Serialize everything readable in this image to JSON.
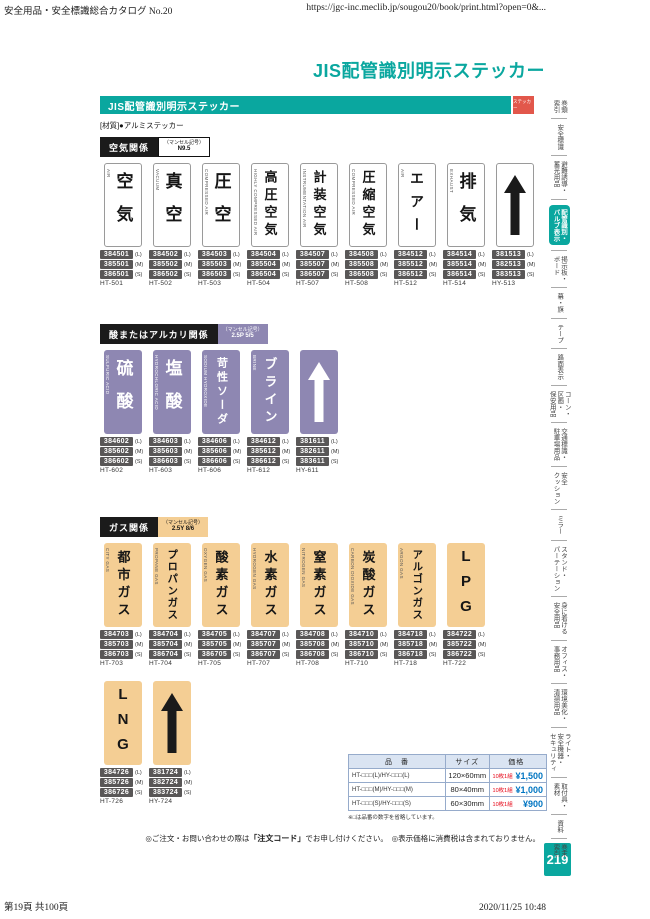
{
  "page": {
    "print_header_left": "安全用品・安全標識総合カタログ No.20",
    "print_header_right": "https://jgc-inc.meclib.jp/sougou20/book/print.html?open=0&...",
    "title": "JIS配管識別明示ステッカー",
    "banner_label": "JIS配管識別明示ステッカー",
    "banner_tag": "ステッカー",
    "material": "[材質]●アルミステッカー",
    "page_number": "219",
    "footer_left": "第19頁 共100頁",
    "footer_right": "2020/11/25 10:48"
  },
  "order_note": {
    "p1": "◎ご注文・お問い合わせの際は",
    "p2": "「注文コード」",
    "p3": "でお申し付けください。　◎表示価格に消費税は含まれておりません。"
  },
  "size_labels": [
    "(L)",
    "(M)",
    "(S)"
  ],
  "sections": [
    {
      "label": "空気関係",
      "munsell_label": "（マンセル記号）",
      "munsell_value": "N9.5",
      "style": "white",
      "rows": [
        [
          {
            "jp": "空気",
            "en": "AIR",
            "codes": [
              "384501",
              "385501",
              "386501"
            ],
            "model": "HT-501"
          },
          {
            "jp": "真空",
            "en": "VACUUM",
            "codes": [
              "384502",
              "385502",
              "386502"
            ],
            "model": "HT-502"
          },
          {
            "jp": "圧空",
            "en": "COMPRESSED AIR",
            "codes": [
              "384503",
              "385503",
              "386503"
            ],
            "model": "HT-503"
          },
          {
            "jp": "高圧空気",
            "en": "HIGHLY COMPRESSED AIR",
            "codes": [
              "384504",
              "385504",
              "386504"
            ],
            "model": "HT-504"
          },
          {
            "jp": "計装空気",
            "en": "INSTRUMENTATION AIR",
            "codes": [
              "384507",
              "385507",
              "386507"
            ],
            "model": "HT-507"
          },
          {
            "jp": "圧縮空気",
            "en": "COMPRESSED AIR",
            "codes": [
              "384508",
              "385508",
              "386508"
            ],
            "model": "HT-508"
          },
          {
            "jp": "エアー",
            "en": "AIR",
            "codes": [
              "384512",
              "385512",
              "386512"
            ],
            "model": "HT-512"
          },
          {
            "jp": "排気",
            "en": "EXHAUST",
            "codes": [
              "384514",
              "385514",
              "386514"
            ],
            "model": "HT-514"
          },
          {
            "arrow": true,
            "icon": "up-arrow",
            "codes": [
              "381513",
              "382513",
              "383513"
            ],
            "model": "HY-513"
          }
        ]
      ]
    },
    {
      "label": "酸またはアルカリ関係",
      "munsell_label": "（マンセル記号）",
      "munsell_value": "2.5P 5/5",
      "style": "purple",
      "rows": [
        [
          {
            "jp": "硫酸",
            "en": "SULFURIC ACID",
            "codes": [
              "384602",
              "385602",
              "386602"
            ],
            "model": "HT-602"
          },
          {
            "jp": "塩酸",
            "en": "HYDROCHLORIC ACID",
            "codes": [
              "384603",
              "385603",
              "386603"
            ],
            "model": "HT-603"
          },
          {
            "jp": "苛性ソーダ",
            "en": "SODIUM HYDROXIDE",
            "codes": [
              "384606",
              "385606",
              "386606"
            ],
            "model": "HT-606"
          },
          {
            "jp": "ブライン",
            "en": "BRINE",
            "codes": [
              "384612",
              "385612",
              "386612"
            ],
            "model": "HT-612"
          },
          {
            "arrow": true,
            "icon": "up-arrow",
            "codes": [
              "381611",
              "382611",
              "383611"
            ],
            "model": "HY-611"
          }
        ]
      ]
    },
    {
      "label": "ガス関係",
      "munsell_label": "（マンセル記号）",
      "munsell_value": "2.5Y 8/6",
      "style": "tan",
      "rows": [
        [
          {
            "jp": "都市ガス",
            "en": "CITY GAS",
            "codes": [
              "384703",
              "385703",
              "386703"
            ],
            "model": "HT-703"
          },
          {
            "jp": "プロパンガス",
            "en": "PROPANE GAS",
            "codes": [
              "384704",
              "385704",
              "386704"
            ],
            "model": "HT-704"
          },
          {
            "jp": "酸素ガス",
            "en": "OXYGEN GAS",
            "codes": [
              "384705",
              "385705",
              "386705"
            ],
            "model": "HT-705"
          },
          {
            "jp": "水素ガス",
            "en": "HYDROGEN GAS",
            "codes": [
              "384707",
              "385707",
              "386707"
            ],
            "model": "HT-707"
          },
          {
            "jp": "窒素ガス",
            "en": "NITROGEN GAS",
            "codes": [
              "384708",
              "385708",
              "386708"
            ],
            "model": "HT-708"
          },
          {
            "jp": "炭酸ガス",
            "en": "CARBON DIOXIDE GAS",
            "codes": [
              "384710",
              "385710",
              "386710"
            ],
            "model": "HT-710"
          },
          {
            "jp": "アルゴンガス",
            "en": "ARGON GAS",
            "codes": [
              "384718",
              "385718",
              "386718"
            ],
            "model": "HT-718"
          },
          {
            "jp": "LPG",
            "en": "",
            "latin": true,
            "codes": [
              "384722",
              "385722",
              "386722"
            ],
            "model": "HT-722"
          }
        ],
        [
          {
            "jp": "LNG",
            "en": "",
            "latin": true,
            "codes": [
              "384726",
              "385726",
              "386726"
            ],
            "model": "HT-726"
          },
          {
            "arrow": true,
            "icon": "up-arrow",
            "codes": [
              "381724",
              "382724",
              "383724"
            ],
            "model": "HY-724"
          }
        ]
      ]
    }
  ],
  "price_table": {
    "headers": [
      "品　番",
      "サイズ",
      "価格"
    ],
    "rows": [
      {
        "part": "HT-□□□(L)/HY-□□□(L)",
        "size": "120×60mm",
        "unit": "10枚1組",
        "price": "¥1,500"
      },
      {
        "part": "HT-□□□(M)/HY-□□□(M)",
        "size": "80×40mm",
        "unit": "10枚1組",
        "price": "¥1,000"
      },
      {
        "part": "HT-□□□(S)/HY-□□□(S)",
        "size": "60×30mm",
        "unit": "10枚1組",
        "price": "¥900"
      }
    ],
    "note": "※□は品番の数字を省略しています。"
  },
  "sidebar": {
    "items": [
      {
        "label": "巻頭\n索引",
        "active": false
      },
      {
        "label": "安全標識",
        "active": false
      },
      {
        "label": "避難誘導・\n蓄光用品",
        "active": false
      },
      {
        "label": "配管識別・\nバルブ表示",
        "active": true
      },
      {
        "label": "掲示板・\nボード",
        "active": false
      },
      {
        "label": "幕・旗",
        "active": false
      },
      {
        "label": "テープ",
        "active": false
      },
      {
        "label": "路面表示",
        "active": false
      },
      {
        "label": "コーン・\n区画・\n保安用品",
        "active": false
      },
      {
        "label": "交通標識・\n駐車場用品",
        "active": false
      },
      {
        "label": "安全\nクッション",
        "active": false
      },
      {
        "label": "ミラー",
        "active": false
      },
      {
        "label": "スタンド・\nパーテーション",
        "active": false
      },
      {
        "label": "身に着ける\n安全用品",
        "active": false
      },
      {
        "label": "オフィス・\n事務用品",
        "active": false
      },
      {
        "label": "環境美化・\n清掃用品",
        "active": false
      },
      {
        "label": "ライト・\n安全機器・\nセキュリティ",
        "active": false
      },
      {
        "label": "取付具・\n素材",
        "active": false
      },
      {
        "label": "資料",
        "active": false
      },
      {
        "label": "巻末\n索引",
        "active": false
      }
    ]
  },
  "colors": {
    "teal": "#0AA79F",
    "tag_red": "#E2574B",
    "purple": "#8E87B2",
    "tan": "#F4CE94",
    "badge_gray": "#595757",
    "table_border": "#96ABCB",
    "price_red": "#E60012",
    "price_blue": "#0075C2"
  }
}
